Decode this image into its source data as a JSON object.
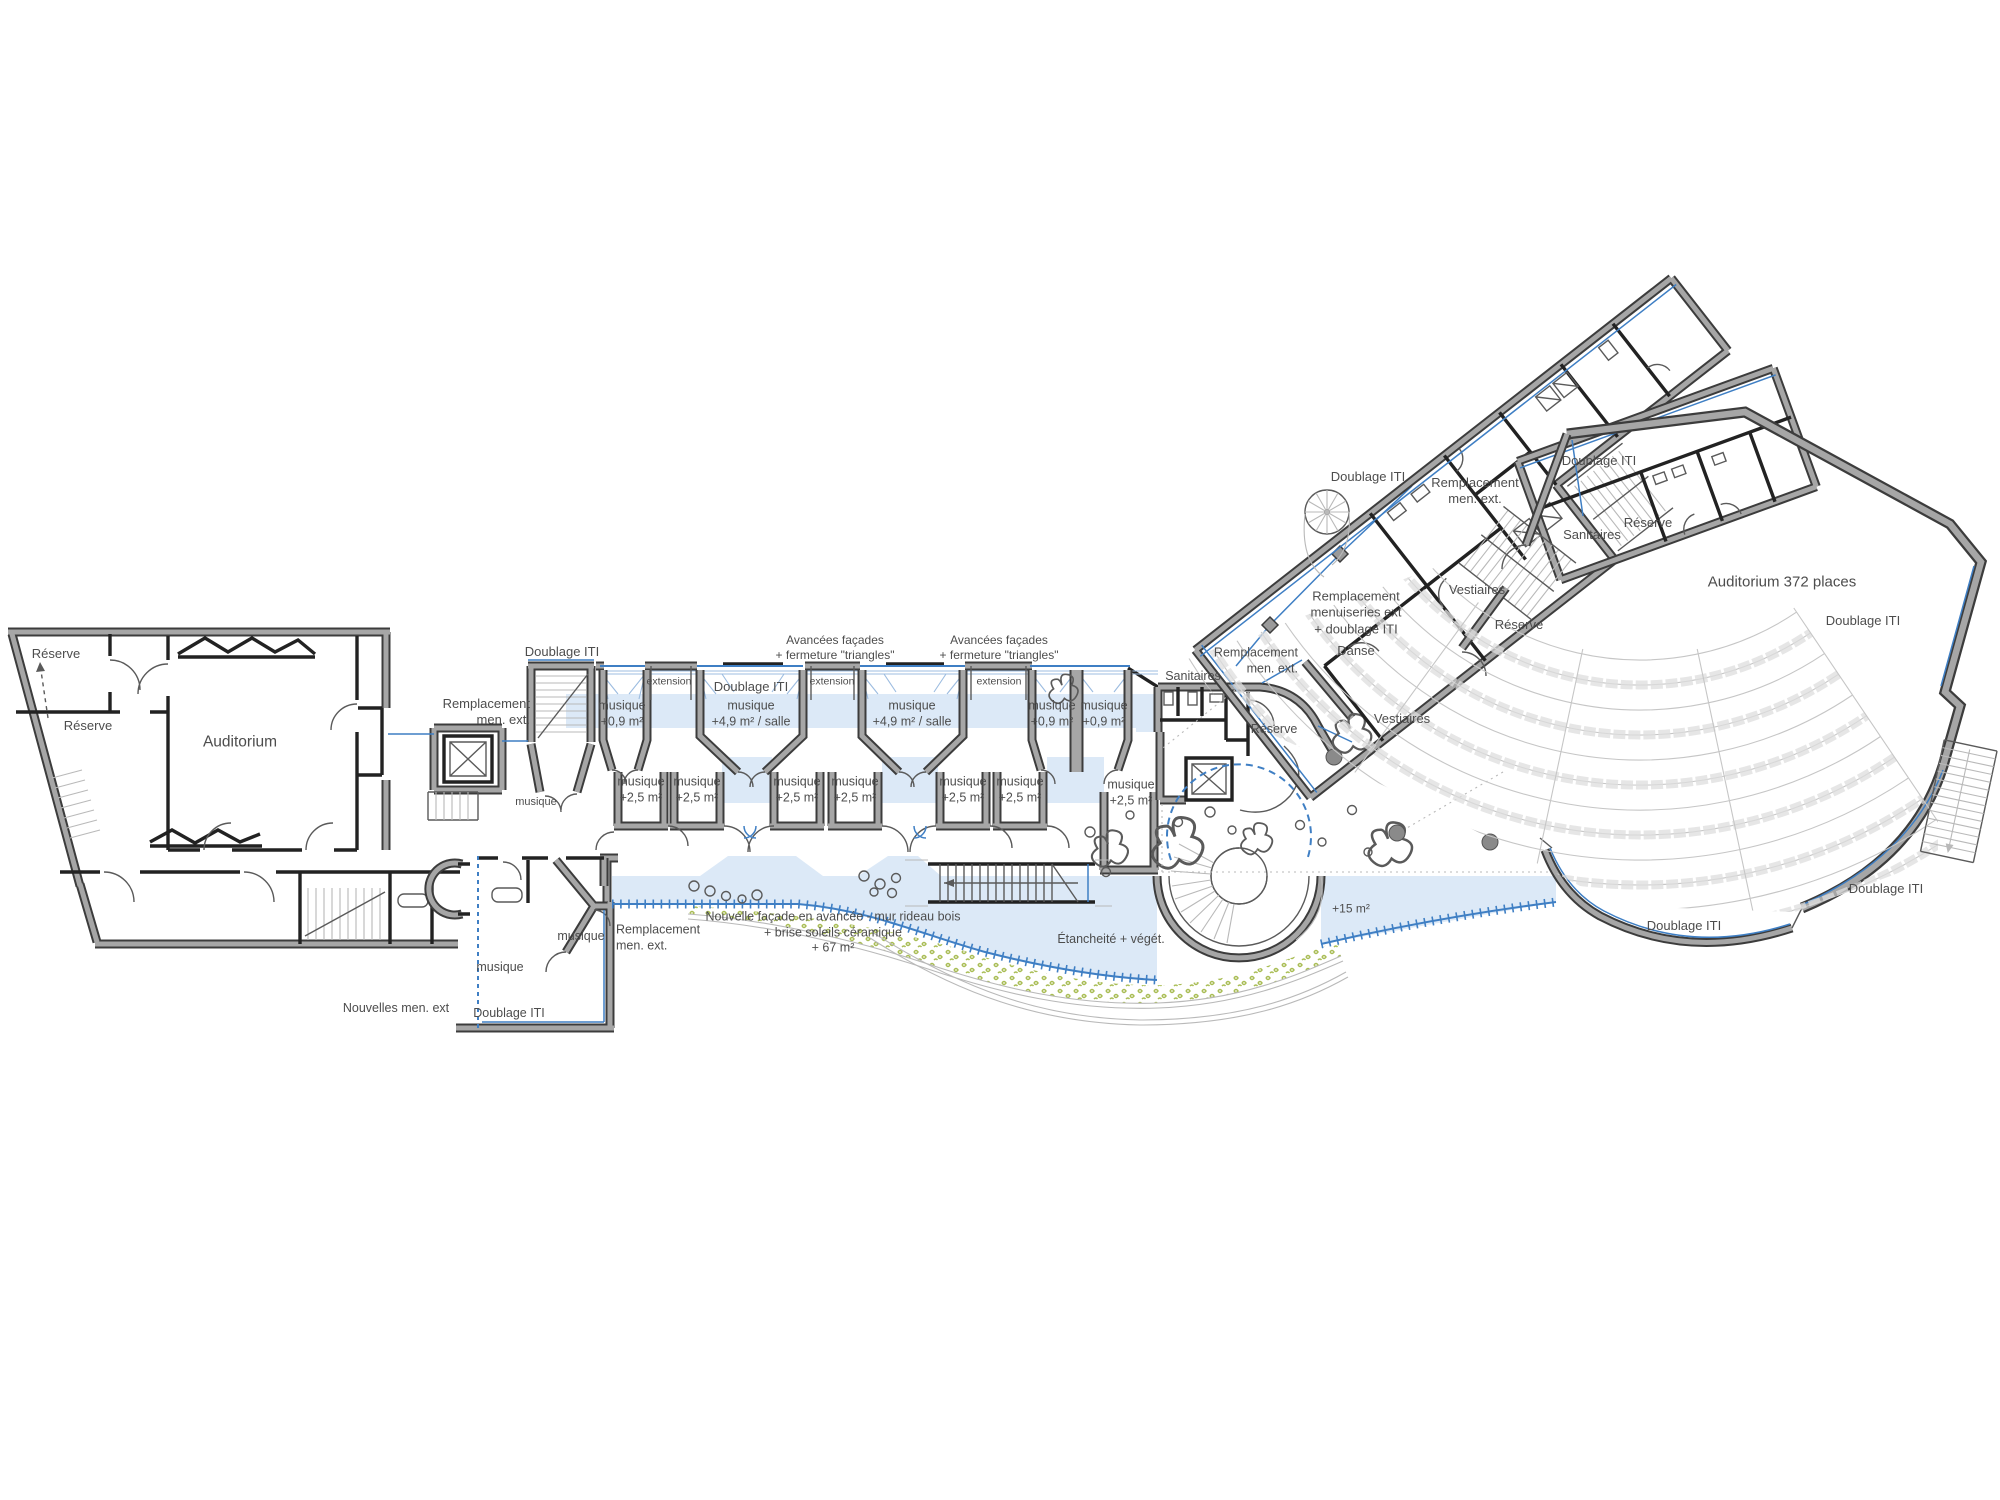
{
  "document": {
    "type": "architectural floor plan",
    "language": "French"
  },
  "colors": {
    "wall_outline": "#3c3c3c",
    "wall_fill": "#a6a6a6",
    "interior_wall": "#222222",
    "accent_blue": "#3f7fc4",
    "light_blue_fill": "#dce9f7",
    "vegetation_green": "#a9bd55",
    "seat_gray": "#c6c6c6",
    "text": "#4d4d4d"
  },
  "labels": {
    "reserve": "Réserve",
    "auditorium": "Auditorium",
    "auditorium_372": "Auditorium 372 places",
    "doublage_iti": "Doublage ITI",
    "repl_men_ext": "Remplacement\nmen. ext.",
    "repl_menuiseries": "Remplacement\nmenuiseries ext\n+ doublage ITI",
    "danse": "Danse",
    "vestiaires": "Vestiaires",
    "sanitaires": "Sanitaires",
    "extension": "extension",
    "avancees": "Avancées façades\n+ fermeture \"triangles\"",
    "musique": "musique",
    "musique_09": "musique\n+0,9 m²",
    "musique_49": "musique\n+4,9 m² / salle",
    "musique_25": "musique\n+2,5 m²",
    "nouvelles_men_ext": "Nouvelles men. ext",
    "nouvelle_facade": "Nouvelle façade en avancée - mur rideau bois\n+ brise soleils céramique\n+ 67 m²",
    "etancheite": "Étancheité + végét.",
    "plus_15": "+15 m²"
  }
}
